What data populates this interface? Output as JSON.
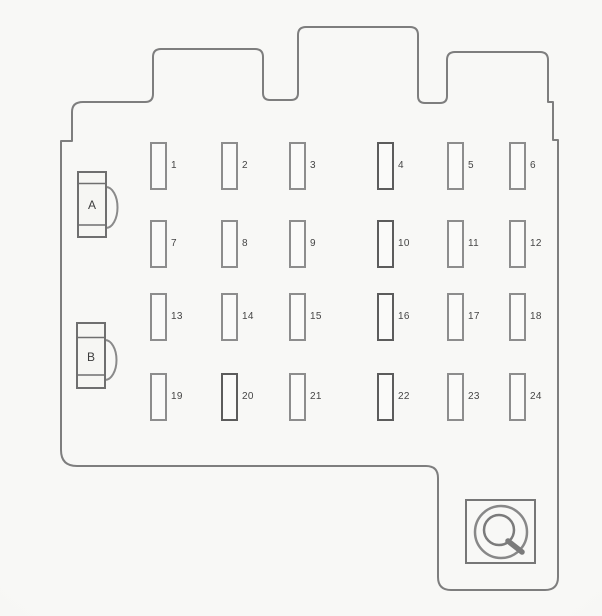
{
  "diagram": {
    "kind": "fuse-box-panel-diagram",
    "grid": {
      "rows": 4,
      "columns": 6
    },
    "connectors": [
      {
        "label": "A"
      },
      {
        "label": "B"
      }
    ],
    "fuses": [
      {
        "label": "1"
      },
      {
        "label": "2"
      },
      {
        "label": "3"
      },
      {
        "label": "4"
      },
      {
        "label": "5"
      },
      {
        "label": "6"
      },
      {
        "label": "7"
      },
      {
        "label": "8"
      },
      {
        "label": "9"
      },
      {
        "label": "10"
      },
      {
        "label": "11"
      },
      {
        "label": "12"
      },
      {
        "label": "13"
      },
      {
        "label": "14"
      },
      {
        "label": "15"
      },
      {
        "label": "16"
      },
      {
        "label": "17"
      },
      {
        "label": "18"
      },
      {
        "label": "19"
      },
      {
        "label": "20"
      },
      {
        "label": "21"
      },
      {
        "label": "22"
      },
      {
        "label": "23"
      },
      {
        "label": "24"
      }
    ],
    "icons": {
      "mount": "mounting-screw-icon"
    },
    "colors": {
      "outline": "#7e7e7e",
      "connector_line": "#6f6f6f",
      "fuse_outline": "#8d8d8d",
      "fuse_outline_dark": "#5c5c5c",
      "text": "#454545",
      "paper": "#f7f7f4"
    }
  }
}
